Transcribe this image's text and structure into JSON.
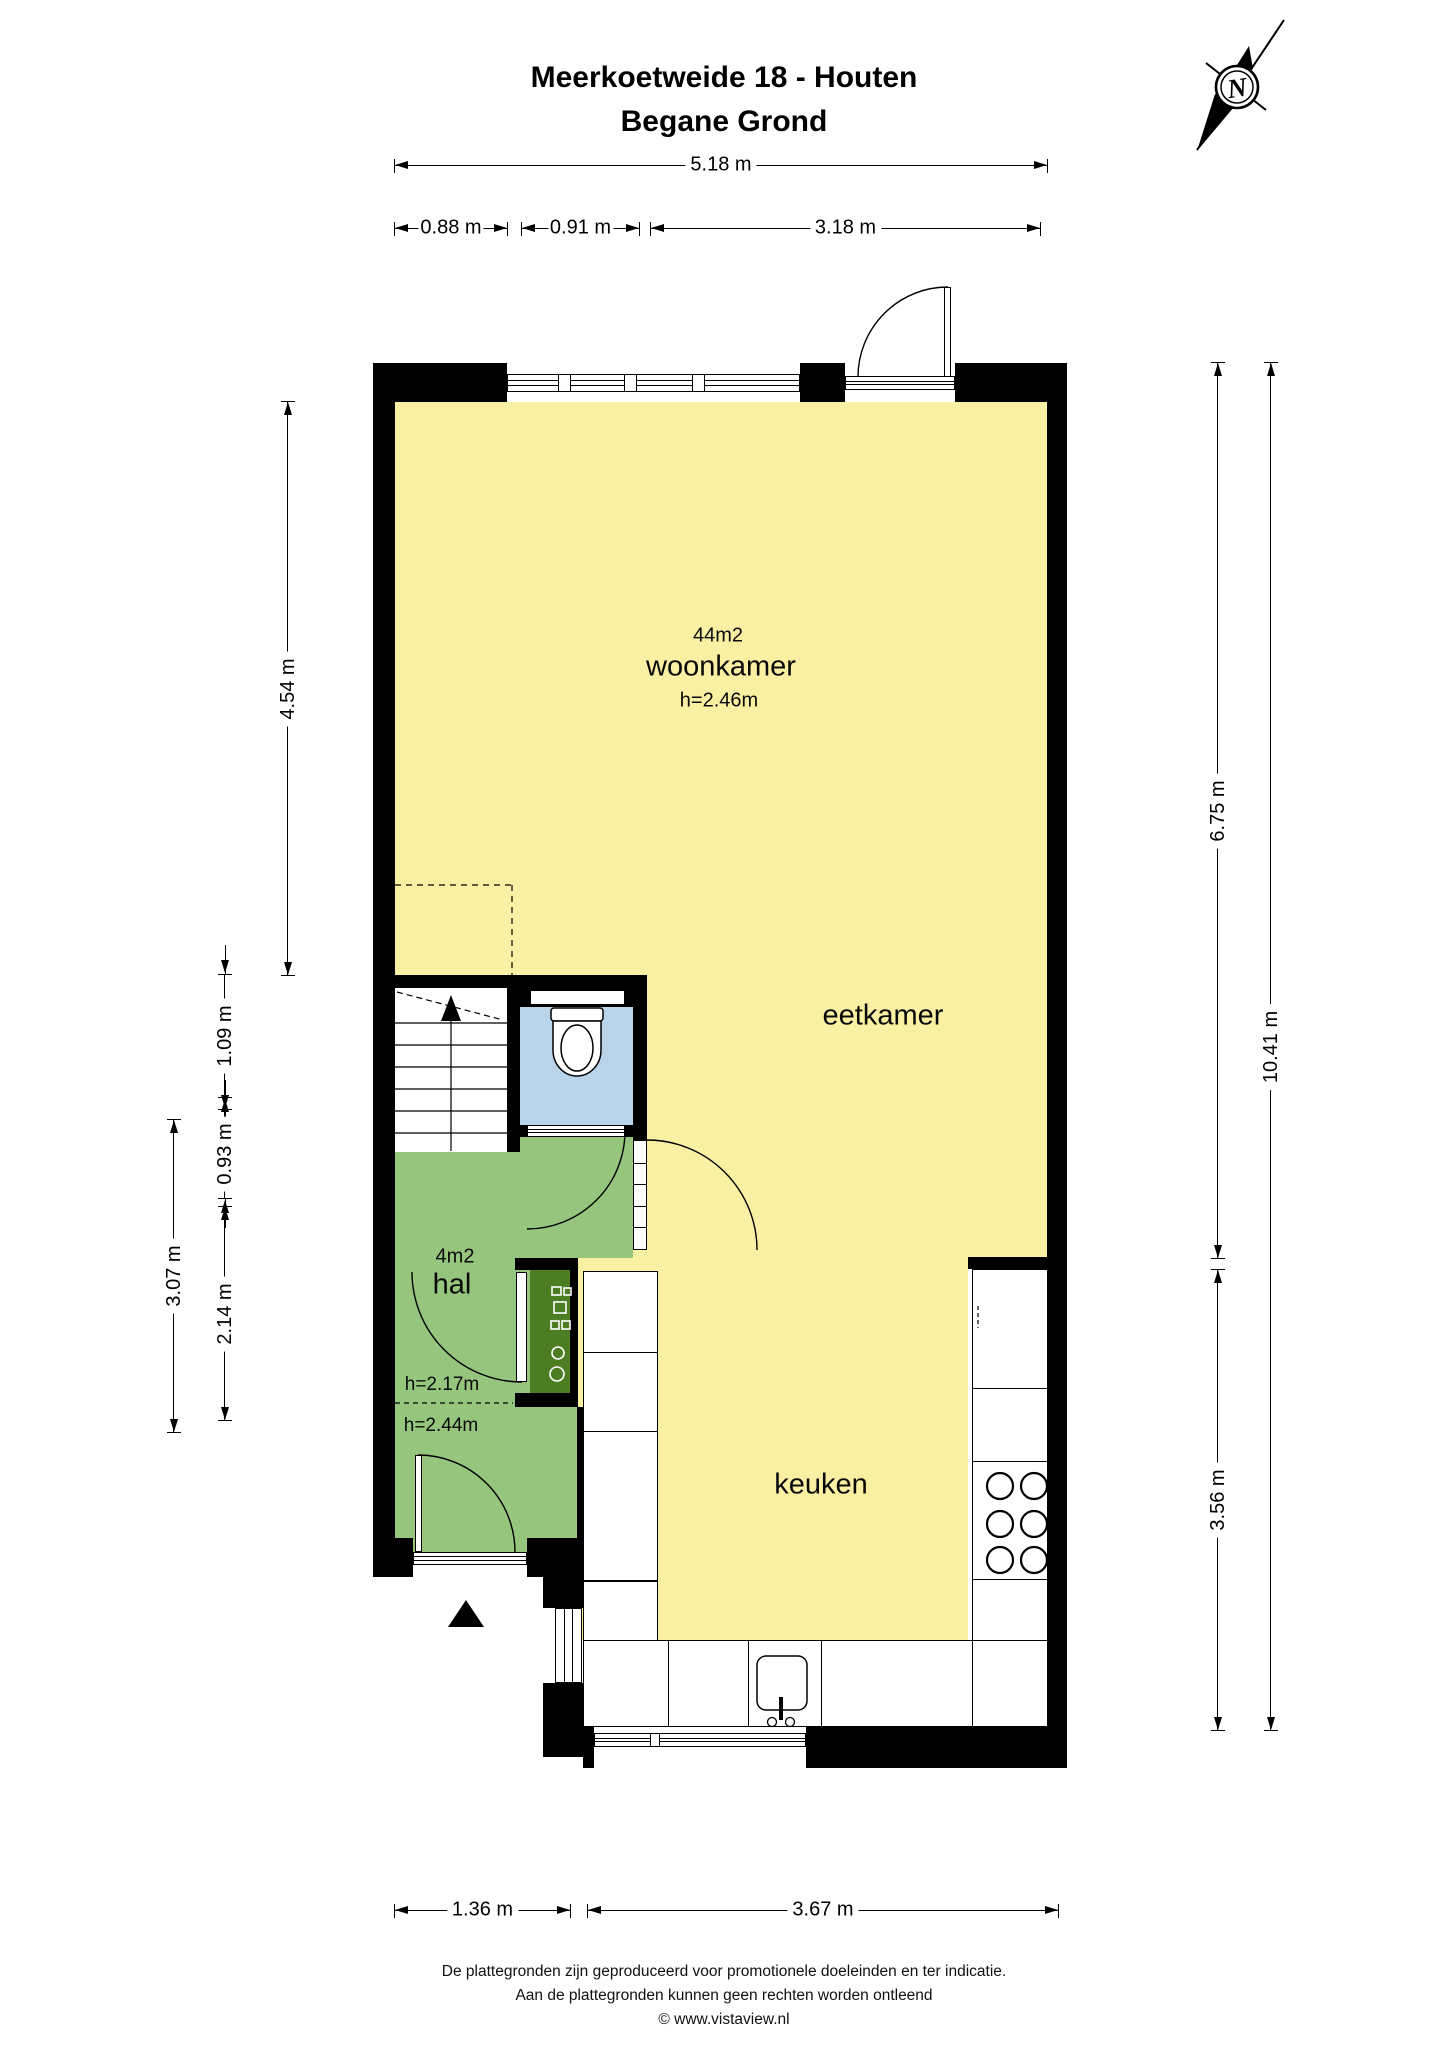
{
  "title": {
    "line1": "Meerkoetweide 18 - Houten",
    "line2": "Begane Grond"
  },
  "compass": {
    "label": "N"
  },
  "rooms": {
    "woonkamer": {
      "area": "44m2",
      "label": "woonkamer",
      "ceiling": "h=2.46m"
    },
    "eetkamer": {
      "label": "eetkamer"
    },
    "keuken": {
      "label": "keuken"
    },
    "hal": {
      "area": "4m2",
      "label": "hal",
      "ceiling_front": "h=2.17m",
      "ceiling_back": "h=2.44m"
    }
  },
  "dimensions": {
    "top_total": "5.18 m",
    "top_a": "0.88 m",
    "top_b": "0.91 m",
    "top_c": "3.18 m",
    "left_woonkamer": "4.54 m",
    "left_a": "1.09 m",
    "left_b": "0.93 m",
    "left_hal": "2.14 m",
    "left_hal_total": "3.07 m",
    "right_a": "6.75 m",
    "right_total": "10.41 m",
    "right_b": "3.56 m",
    "bottom_a": "1.36 m",
    "bottom_b": "3.67 m"
  },
  "footer": {
    "line1": "De plattegronden zijn geproduceerd voor promotionele doeleinden en ter indicatie.",
    "line2": "Aan de plattegronden kunnen geen rechten worden ontleend",
    "line3": "© www.vistaview.nl"
  },
  "colors": {
    "wall": "#000000",
    "floor_living": "#FAF0A3",
    "floor_hal": "#96C57D",
    "meterkast": "#4D7D22",
    "floor_toilet": "#B9D3EA",
    "paper": "#FFFFFF"
  },
  "icons": {
    "compass": "compass-north-icon",
    "toilet": "toilet-icon",
    "sink": "sink-icon",
    "hob": "hob-icon",
    "stairs_arrow": "stairs-up-arrow-icon",
    "entrance": "entrance-arrow-icon"
  }
}
